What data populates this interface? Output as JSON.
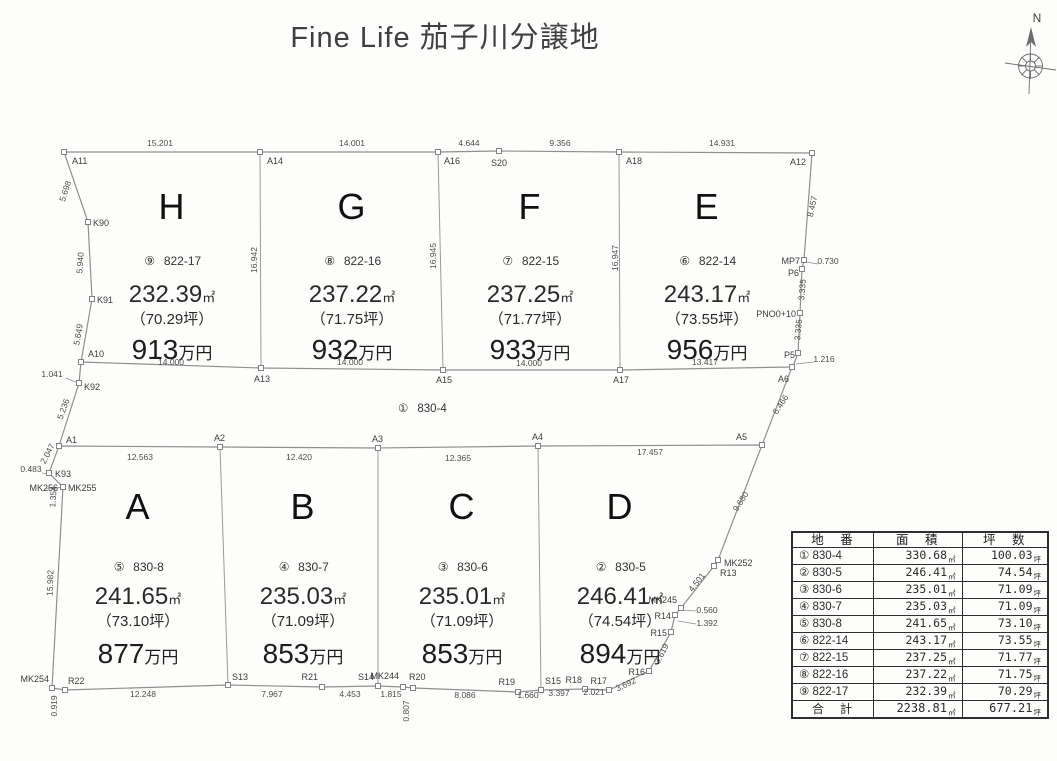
{
  "title": "Fine Life 茄子川分譲地",
  "compass": {
    "label": "N"
  },
  "road": {
    "circle": "①",
    "parcel": "830-4"
  },
  "units": {
    "area": "㎡",
    "price": "万円"
  },
  "lots": [
    {
      "letter": "H",
      "circle": "⑨",
      "parcel": "822-17",
      "area": "232.39",
      "tsubo": "（70.29坪）",
      "price": "913"
    },
    {
      "letter": "G",
      "circle": "⑧",
      "parcel": "822-16",
      "area": "237.22",
      "tsubo": "（71.75坪）",
      "price": "932"
    },
    {
      "letter": "F",
      "circle": "⑦",
      "parcel": "822-15",
      "area": "237.25",
      "tsubo": "（71.77坪）",
      "price": "933"
    },
    {
      "letter": "E",
      "circle": "⑥",
      "parcel": "822-14",
      "area": "243.17",
      "tsubo": "（73.55坪）",
      "price": "956"
    },
    {
      "letter": "A",
      "circle": "⑤",
      "parcel": "830-8",
      "area": "241.65",
      "tsubo": "（73.10坪）",
      "price": "877"
    },
    {
      "letter": "B",
      "circle": "④",
      "parcel": "830-7",
      "area": "235.03",
      "tsubo": "（71.09坪）",
      "price": "853"
    },
    {
      "letter": "C",
      "circle": "③",
      "parcel": "830-6",
      "area": "235.01",
      "tsubo": "（71.09坪）",
      "price": "853"
    },
    {
      "letter": "D",
      "circle": "②",
      "parcel": "830-5",
      "area": "246.41",
      "tsubo": "（74.54坪）",
      "price": "894"
    }
  ],
  "dimensions": [
    "15.201",
    "14.001",
    "4.644",
    "9.356",
    "14.931",
    "14.000",
    "14.000",
    "14.000",
    "13.417",
    "16.942",
    "16.945",
    "16.947",
    "5.698",
    "5.940",
    "5.649",
    "1.041",
    "5.236",
    "8.457",
    "0.730",
    "3.335",
    "3.335",
    "1.216",
    "6.466",
    "9.680",
    "4.501",
    "0.560",
    "1.392",
    "3.619",
    "3.692",
    "2.021",
    "3.397",
    "1.660",
    "8.086",
    "1.815",
    "0.807",
    "4.453",
    "7.967",
    "12.248",
    "0.919",
    "0.483",
    "2.047",
    "1.354",
    "15.982",
    "12.563",
    "12.420",
    "12.365",
    "17.457"
  ],
  "survey_points": [
    "A11",
    "A14",
    "A16",
    "S20",
    "A18",
    "A12",
    "K90",
    "K91",
    "A10",
    "K92",
    "A13",
    "A15",
    "A17",
    "A6",
    "MP7",
    "P6",
    "PNO0+10",
    "P5",
    "A1",
    "A2",
    "A3",
    "A4",
    "A5",
    "MK252",
    "R13",
    "MK245",
    "R14",
    "R15",
    "R16",
    "R17",
    "R18",
    "S15",
    "R19",
    "R20",
    "MK244",
    "S14",
    "R21",
    "S13",
    "R22",
    "MK254",
    "K93",
    "MK256",
    "MK255"
  ],
  "table": {
    "headers": [
      "地　番",
      "面　積",
      "坪　数"
    ],
    "unit_area": "㎡",
    "unit_tsubo": "坪",
    "rows": [
      {
        "no": "①",
        "parcel": "830-4",
        "area": "330.68",
        "tsubo": "100.03"
      },
      {
        "no": "②",
        "parcel": "830-5",
        "area": "246.41",
        "tsubo": "74.54"
      },
      {
        "no": "③",
        "parcel": "830-6",
        "area": "235.01",
        "tsubo": "71.09"
      },
      {
        "no": "④",
        "parcel": "830-7",
        "area": "235.03",
        "tsubo": "71.09"
      },
      {
        "no": "⑤",
        "parcel": "830-8",
        "area": "241.65",
        "tsubo": "73.10"
      },
      {
        "no": "⑥",
        "parcel": "822-14",
        "area": "243.17",
        "tsubo": "73.55"
      },
      {
        "no": "⑦",
        "parcel": "822-15",
        "area": "237.25",
        "tsubo": "71.77"
      },
      {
        "no": "⑧",
        "parcel": "822-16",
        "area": "237.22",
        "tsubo": "71.75"
      },
      {
        "no": "⑨",
        "parcel": "822-17",
        "area": "232.39",
        "tsubo": "70.29"
      }
    ],
    "total": {
      "label": "合　計",
      "area": "2238.81",
      "tsubo": "677.21"
    }
  }
}
